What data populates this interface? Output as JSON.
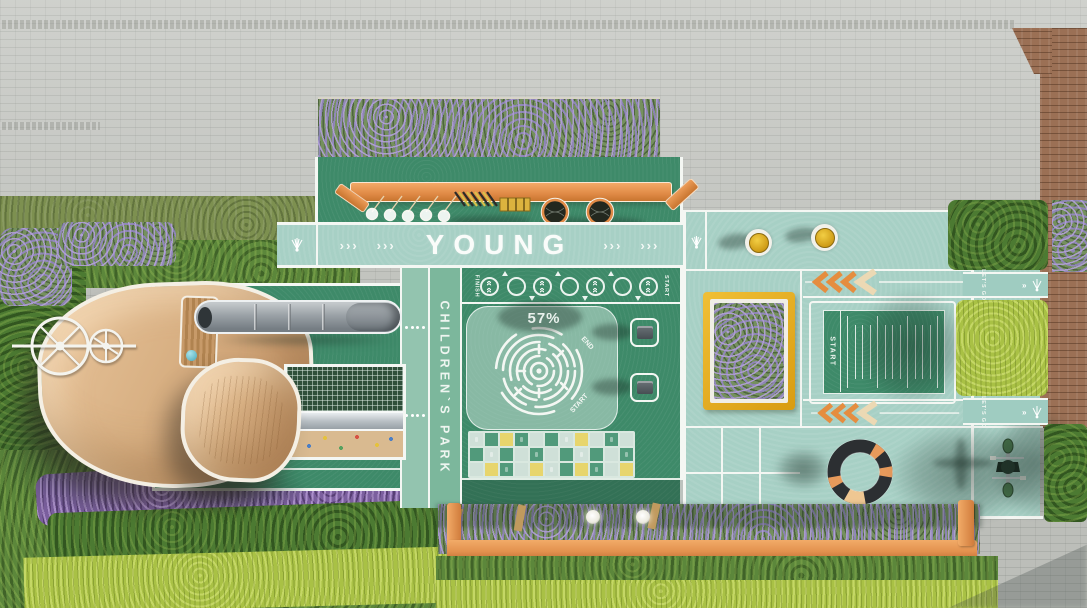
{
  "scene": {
    "description": "Aerial 3D render of a children's park playground plan"
  },
  "labels": {
    "young": "YOUNG",
    "childrens_park": "CHILDREN`S PARK"
  },
  "young_band": {
    "arrow_groups": [
      "›››",
      "›››",
      "›››",
      "›››"
    ]
  },
  "maze": {
    "percent": "57%",
    "end_label": "END",
    "start_label": "START"
  },
  "hopscotch": {
    "finish_label": "FINISH",
    "start_label": "START",
    "circles": [
      "chevrons",
      "plain",
      "chevrons",
      "plain",
      "chevrons",
      "plain",
      "chevrons"
    ]
  },
  "long_jump": {
    "start_label": "START",
    "tick_count": 13
  },
  "lets_go_lanes": [
    {
      "label": "LET'S GO"
    },
    {
      "label": "LET'S GO"
    }
  ],
  "checkerboard": {
    "pattern": [
      "LGYGLGLYLGL",
      "GLGLGLGLGLG",
      "LYGLYLGYGLY"
    ],
    "palette": {
      "L": "#cfe0d8",
      "G": "#519a7b",
      "Y": "#e7d56d"
    }
  },
  "icons": {
    "shuttlecock": "white shuttlecock ground marking",
    "chevron_marking": "triple chevron lane marking"
  },
  "colors": {
    "court_green": "#3e8a69",
    "stripe_green": "#7cb79c",
    "teal_light": "#a7d0c5",
    "white_line": "#f4f7f3",
    "orange": "#e79a5b",
    "canopy_tan": "#d9b488",
    "planter_yellow": "#e6ac1f",
    "paving_gray": "#c6c8c3",
    "wood_brown": "#9b7055",
    "hedge_green": "#4c7a32",
    "hedge_lime": "#a9c145",
    "lavender_purple": "#a393cd",
    "checker_light": "#cfe0d8",
    "checker_green": "#519a7b",
    "checker_yellow": "#e7d56d"
  }
}
